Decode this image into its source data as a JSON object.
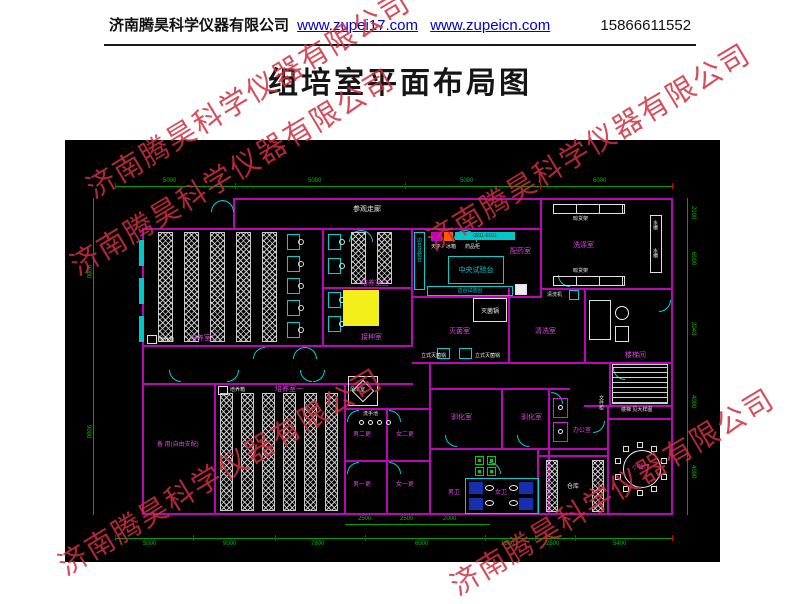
{
  "header": {
    "company": "济南腾昊科学仪器有限公司",
    "link1": "www.zupei17.com",
    "link2": "www.zupeicn.com",
    "phone": "15866611552"
  },
  "title": "组培室平面布局图",
  "watermark": "济南腾昊科学仪器有限公司",
  "plan": {
    "labels": {
      "corridor": "参观走廊",
      "room_py2": "培养室二",
      "room_py3": "培养室三",
      "room_py1": "培养室一",
      "room_jz": "接种室",
      "incubator": "培养箱",
      "room_spare": "备 用(自由支配)",
      "room_peiyao": "配药室",
      "room_xidi": "洗涤室",
      "room_miejun": "灭菌室",
      "room_qingxi": "清洗室",
      "autoclave": "灭菌锅",
      "autoclave_v": "立式灭菌锅",
      "bench_central": "中央试验台",
      "bench_side": "边台试验台",
      "balance": "天平",
      "fridge": "冰箱",
      "cabinet": "药品柜",
      "rack_dry": "晾货架",
      "sink": "水槽",
      "washer": "清洗机",
      "room_fenglin": "风淋室",
      "wash_basin": "洗手池",
      "room_nan2": "男二更",
      "room_nv2": "女二更",
      "room_nan1": "男一更",
      "room_nv1": "女一更",
      "room_nanwei": "男卫",
      "room_nvwei": "女卫",
      "room_xunhua": "驯化室",
      "room_bangong": "办公室",
      "file_cabinet": "文件柜",
      "room_cangku": "仓库",
      "room_canting": "小餐厅",
      "room_louti": "楼梯间",
      "stair_note": "楼梯 见大样图",
      "legend_code": "0911-0101"
    },
    "dims": {
      "top": [
        "5000",
        "5000",
        "5000",
        "6000"
      ],
      "bottom": [
        "5000",
        "9000",
        "7800",
        "6000",
        "1500",
        "2500",
        "5400"
      ],
      "sub": [
        "2500",
        "2500",
        "2000"
      ],
      "left": [
        "9000",
        "9000"
      ],
      "right": [
        "2100",
        "6000",
        "2043",
        "4000",
        "4000"
      ]
    },
    "colors": {
      "wall": "#b806b8",
      "door": "#00d0d0",
      "dim_line": "#00a000",
      "tick": "#d40000",
      "room_label": "#e040e0",
      "highlight": "#f2ef1a",
      "watermark": "#cf2f3f",
      "link": "#0000cc"
    }
  }
}
